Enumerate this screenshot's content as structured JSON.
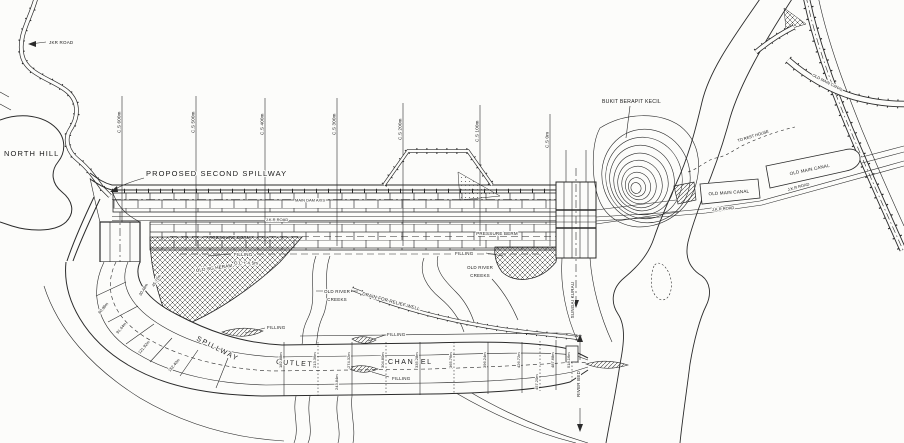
{
  "colors": {
    "paper": "#fcfcfa",
    "ink": "#2b2b2b"
  },
  "labels": {
    "jkr_road_top": "JKR ROAD",
    "north_hill": "NORTH HILL",
    "proposed_second_spillway": "PROPOSED SECOND SPILLWAY",
    "main_dam_axis": "MAIN DAM AXIS",
    "jkr_road_dam": "J.K.R ROAD",
    "pressure_berm": "PRESSURE BERM",
    "filling": "FILLING",
    "filling_level": "O.L + 4.5m",
    "old_sg_heram": "OLD SG HERAM",
    "old_river": "OLD RIVER",
    "creeks": "CREEKS",
    "spillway": "SPILLWAY",
    "outlet": "OUTLET",
    "channel": "CHANNEL",
    "drain_relief_well": "DRAIN FOR RELIEF WELL",
    "sungai_kurau": "SUNGAI KURAU",
    "river_bed": "RIVER BED",
    "bukit_berapit_kecil": "BUKIT BERAPIT KECIL",
    "to_rest_house": "TO REST HOUSE",
    "old_main_canal": "OLD MAIN CANAL",
    "jkr_road_right": "J.K.R ROAD"
  },
  "sections": [
    {
      "label": "C.S 600m"
    },
    {
      "label": "C.S 500m"
    },
    {
      "label": "C.S 400m"
    },
    {
      "label": "C.S 300m"
    },
    {
      "label": "C.S 200m"
    },
    {
      "label": "C.S 100m"
    },
    {
      "label": "C.S 0m"
    }
  ],
  "chainages_curve": [
    "30.48m",
    "45.72m",
    "60.96m",
    "91.44m",
    "121.92m",
    "152.40m"
  ],
  "chainages_channel": [
    "182.88m",
    "213.36m",
    "243.84m",
    "274.32m",
    "304.80m",
    "335.28m",
    "365.76m",
    "396.24m",
    "426.72m",
    "457.20m",
    "487.68m",
    "518.16m"
  ]
}
